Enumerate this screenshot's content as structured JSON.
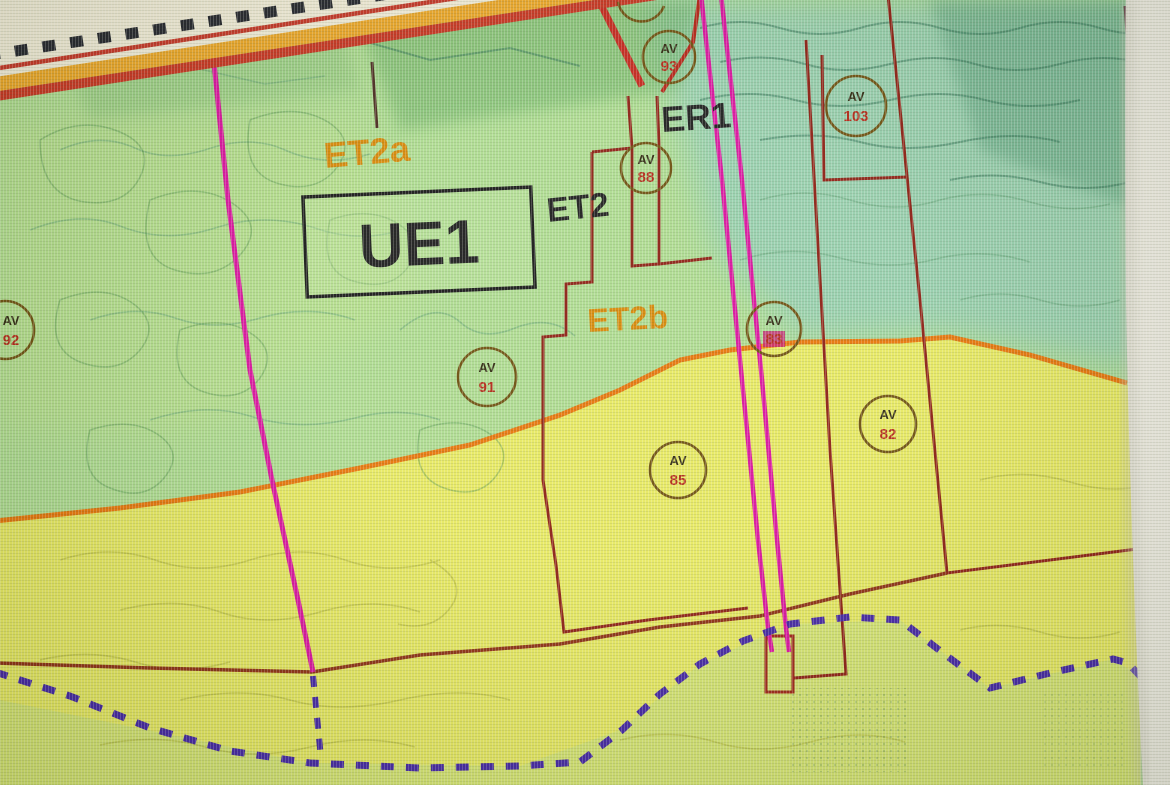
{
  "map": {
    "zone_labels": {
      "et2a": "ET2a",
      "ue1": "UE1",
      "et2": "ET2",
      "er1": "ER1",
      "et2b": "ET2b"
    },
    "markers": [
      {
        "prefix": "AV",
        "number": "93"
      },
      {
        "prefix": "AV",
        "number": "88"
      },
      {
        "prefix": "AV",
        "number": "103"
      },
      {
        "prefix": "AV",
        "number": "92"
      },
      {
        "prefix": "AV",
        "number": "91"
      },
      {
        "prefix": "AV",
        "number": "85"
      },
      {
        "prefix": "AV",
        "number": "83"
      },
      {
        "prefix": "AV",
        "number": "82"
      }
    ],
    "colors": {
      "zone_green": "#aeda92",
      "zone_teal": "#9bcfb0",
      "zone_yellow": "#e7e966",
      "orange_boundary": "#e2760e",
      "dark_red_line": "#8a1f14",
      "magenta_line": "#d5159c",
      "purple_dashed": "#4326a0",
      "label_orange": "#d4880c",
      "label_black": "#1c1c1c",
      "marker_ring": "#6d4f10",
      "marker_number": "#b02818",
      "road_orange": "#e9a62c",
      "road_red": "#c23522",
      "road_cream": "#f2ecd8",
      "screen_edge": "#efece2"
    }
  }
}
